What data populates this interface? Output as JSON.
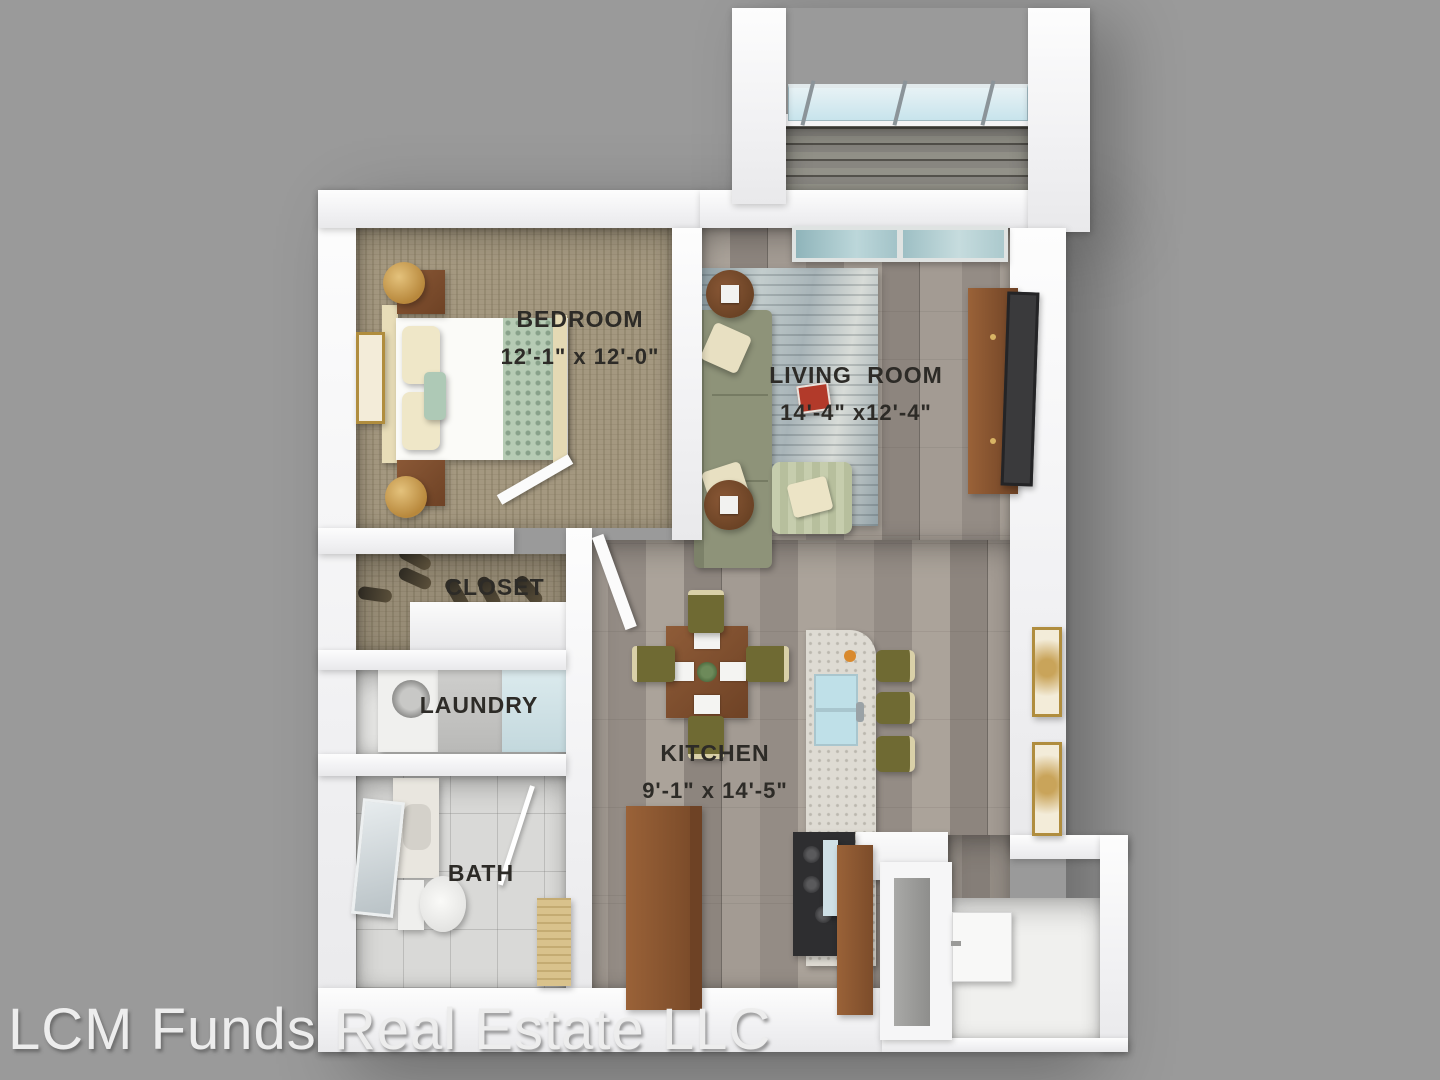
{
  "watermark": {
    "text": "LCM Funds Real Estate LLC"
  },
  "rooms": {
    "bedroom": {
      "label": "BEDROOM",
      "dimensions": "12'-1\" x 12'-0\""
    },
    "living_room": {
      "label": "LIVING ROOM",
      "dimensions": "14'-4\" x12'-4\""
    },
    "closet": {
      "label": "CLOSET"
    },
    "laundry": {
      "label": "LAUNDRY"
    },
    "kitchen": {
      "label": "KITCHEN",
      "dimensions": "9'-1\" x 14'-5\""
    },
    "bath": {
      "label": "BATH"
    }
  },
  "palette": {
    "background": "#9a9a9a",
    "wall": "#f6f6f7",
    "label_text": "#2d2b27",
    "carpet": "#a49880",
    "hardwood": "#9b938c",
    "balcony_deck": "#8f8e89",
    "bath_tile": "#d9d9d7",
    "rug": "#aab8bc",
    "sofa": "#8e9379",
    "armchair": "#c2c9a9",
    "chair_olive": "#6f6a33",
    "wood_furniture": "#8a5836",
    "island_marble": "#dedbd3",
    "sink_glass_blue": "#c3e2ea"
  }
}
